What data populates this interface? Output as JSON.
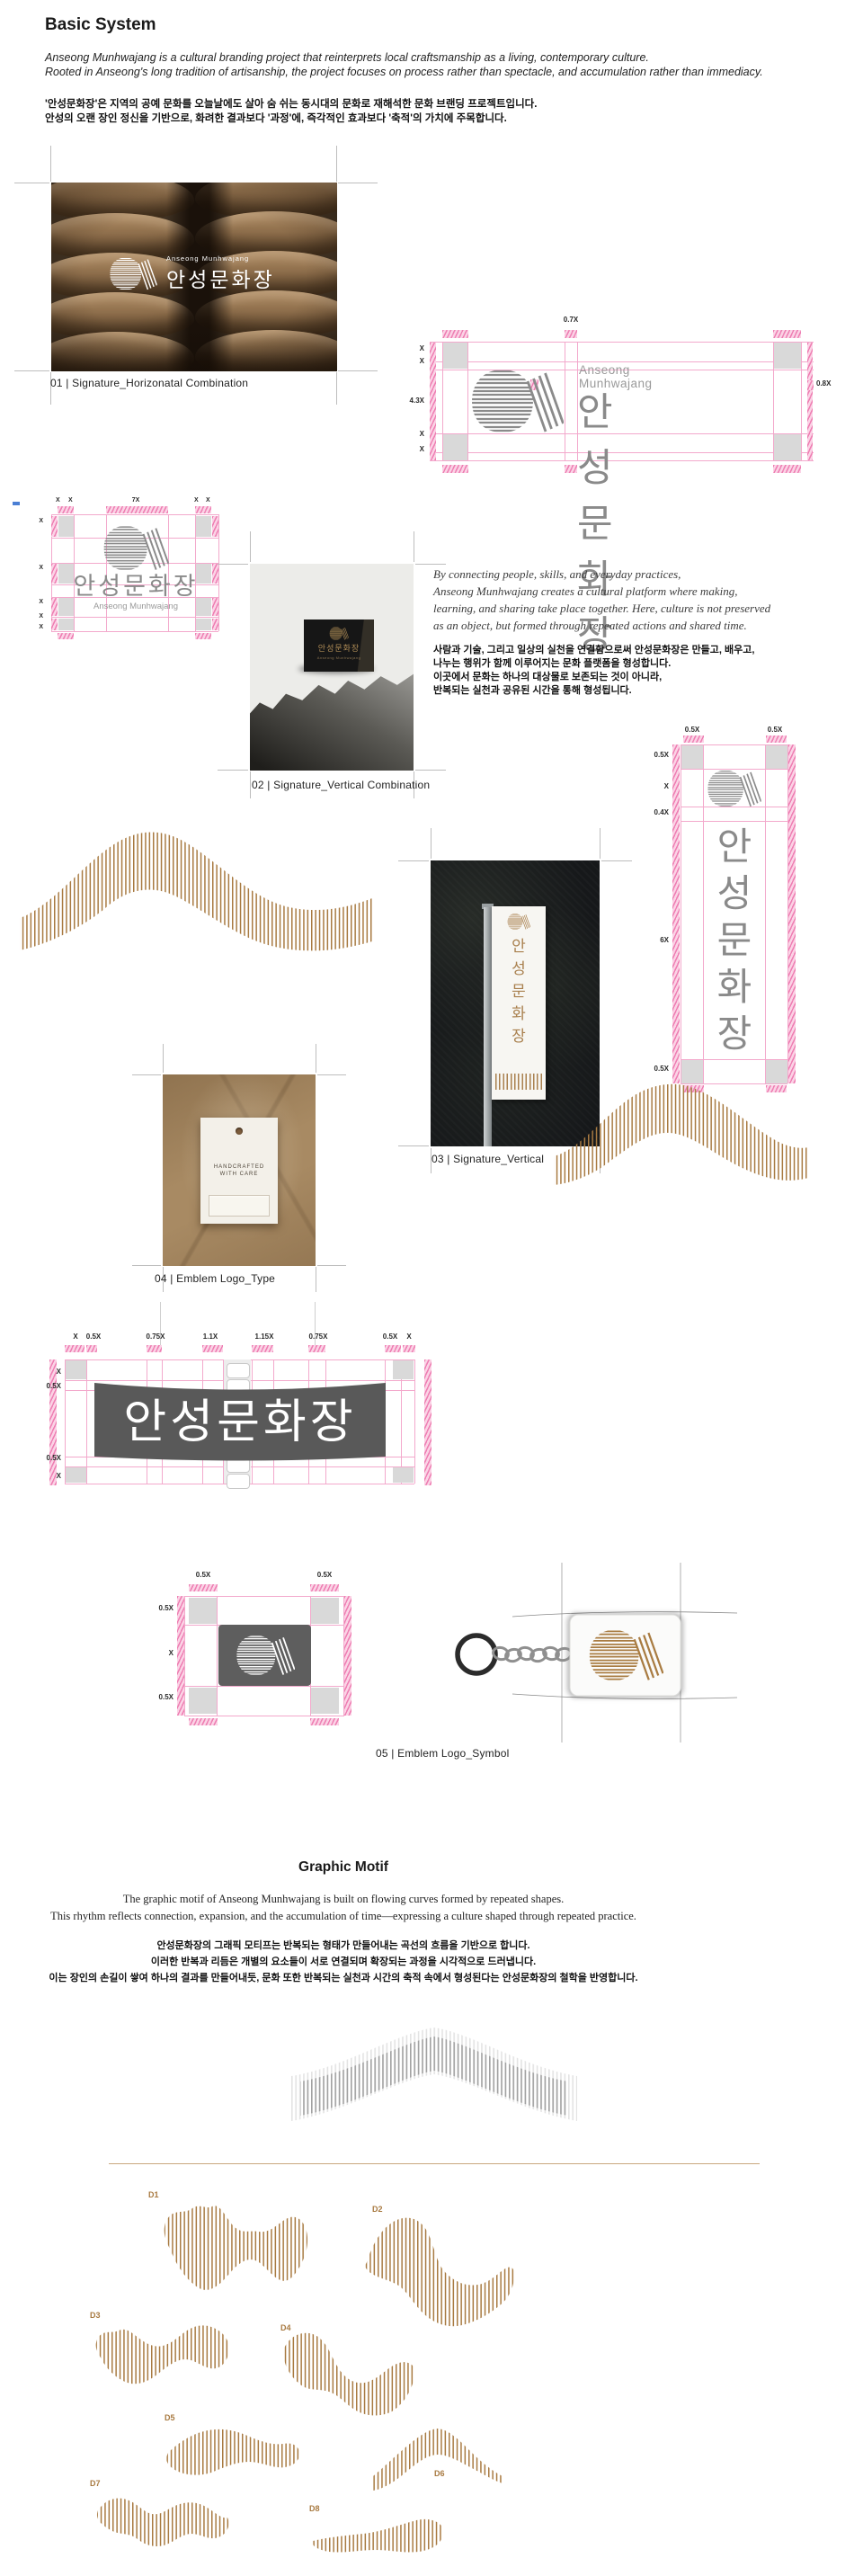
{
  "brand": {
    "name_en": "Anseong Munhwajang",
    "name_ko": "안성문화장",
    "vertical_chars": [
      "안",
      "성",
      "문",
      "화",
      "장"
    ]
  },
  "header": {
    "title": "Basic System",
    "intro_en": [
      "Anseong Munhwajang is a cultural branding project that reinterprets local craftsmanship as a living, contemporary culture.",
      "Rooted in Anseong's long tradition of artisanship, the project focuses on process rather than spectacle, and accumulation rather than immediacy."
    ],
    "intro_ko": [
      "'안성문화장'은 지역의 공예 문화를 오늘날에도 살아 숨 쉬는 동시대의 문화로 재해석한 문화 브랜딩 프로젝트입니다.",
      "안성의 오랜 장인 정신을 기반으로, 화려한 결과보다 '과정'에, 즉각적인 효과보다 '축적'의 가치에 주목합니다."
    ]
  },
  "captions": {
    "c01": "01 | Signature_Horizonatal Combination",
    "c02": "02 | Signature_Vertical Combination",
    "c03": "03 | Signature_Vertical",
    "c04": "04 | Emblem Logo_Type",
    "c05": "05 | Emblem Logo_Symbol"
  },
  "diagram_horizontal": {
    "left_labels": [
      "X",
      "X",
      "4.3X",
      "X",
      "X"
    ],
    "top_label": "0.7X",
    "right_label": "0.8X"
  },
  "diagram_vertical_combo": {
    "top_labels": [
      "X",
      "X",
      "7X",
      "X",
      "X"
    ],
    "left_labels": [
      "X",
      "X",
      "X",
      "X",
      "X"
    ]
  },
  "diagram_vertical": {
    "top_labels": [
      "0.5X",
      "0.5X"
    ],
    "left_labels": [
      "0.5X",
      "X",
      "0.4X",
      "6X",
      "0.5X"
    ]
  },
  "diagram_type": {
    "top_labels": [
      "X",
      "0.5X",
      "0.75X",
      "1.1X",
      "1.15X",
      "0.75X",
      "0.5X",
      "X"
    ],
    "left_labels": [
      "X",
      "0.5X",
      "0.5X",
      "X"
    ]
  },
  "diagram_symbol": {
    "top_labels": [
      "0.5X",
      "0.5X"
    ],
    "left_labels": [
      "0.5X",
      "X",
      "0.5X"
    ]
  },
  "platform_text": {
    "en": [
      "By connecting people, skills, and everyday practices,",
      "Anseong Munhwajang creates a cultural platform where making,",
      "learning, and sharing take place together. Here, culture is not preserved",
      "as an object, but formed through repeated actions and shared time."
    ],
    "ko": [
      "사람과 기술, 그리고 일상의 실천을 연결함으로써 안성문화장은 만들고, 배우고,",
      "나누는 행위가 함께 이루어지는 문화 플랫폼을 형성합니다.",
      "이곳에서 문화는 하나의 대상물로 보존되는 것이 아니라,",
      "반복되는 실천과 공유된 시간을 통해 형성됩니다."
    ]
  },
  "hangtag": {
    "line1": "HANDCRAFTED",
    "line2": "WITH CARE"
  },
  "graphic_motif": {
    "title": "Graphic Motif",
    "desc_en": [
      "The graphic motif of Anseong Munhwajang is built on flowing curves formed by repeated shapes.",
      "This rhythm reflects connection, expansion, and the accumulation of time—expressing a culture shaped through repeated practice."
    ],
    "desc_ko": [
      "안성문화장의 그래픽 모티프는 반복되는 형태가 만들어내는 곡선의 흐름을 기반으로 합니다.",
      "이러한 반복과 리듬은 개별의 요소들이 서로 연결되며 확장되는 과정을 시각적으로 드러냅니다.",
      "이는 장인의 손길이 쌓여 하나의 결과를 만들어내듯, 문화 또한 반복되는 실천과 시간의 축적 속에서 형성된다는 안성문화장의 철학을 반영합니다."
    ],
    "variants": [
      "D1",
      "D2",
      "D3",
      "D4",
      "D5",
      "D6",
      "D7",
      "D8"
    ]
  },
  "colors": {
    "pink": "#f06ea9",
    "pink_light": "#fbd3e6",
    "gray_square": "#d9d9d9",
    "logo_gray": "#8b8b8b",
    "motif_brown": "#a87a41",
    "gold": "#b08d57",
    "banner_dark": "#595959"
  }
}
